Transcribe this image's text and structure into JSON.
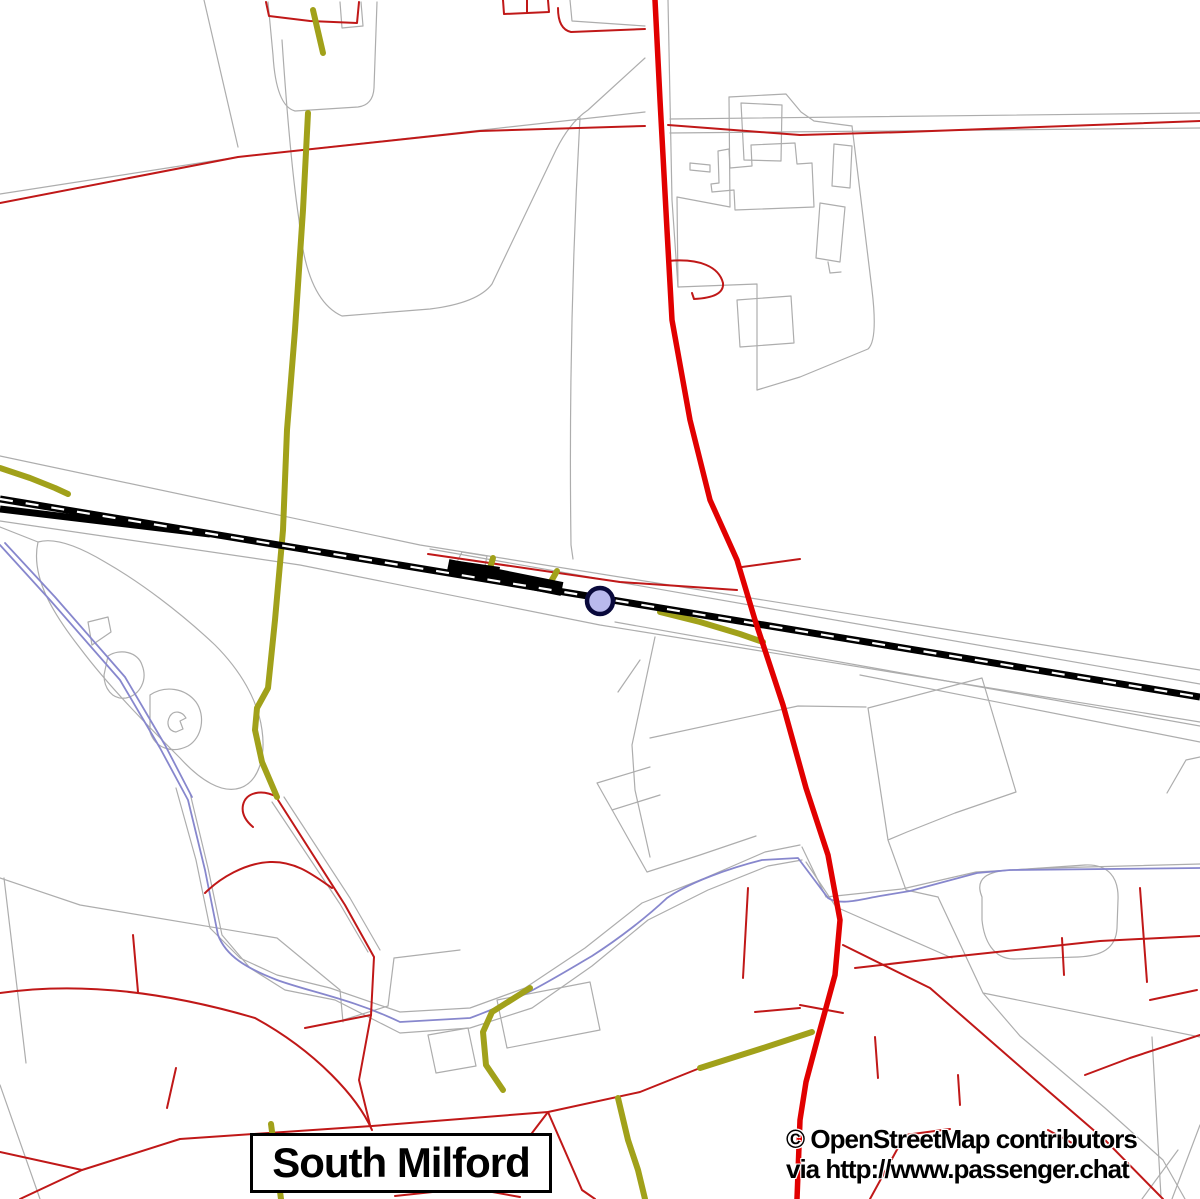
{
  "labels": {
    "place": "South Milford",
    "attribution_line1": "© OpenStreetMap contributors",
    "attribution_line2": "via http://www.passenger.chat"
  },
  "map": {
    "width": 1200,
    "height": 1199,
    "background": "#ffffff",
    "colors": {
      "boundary_gray": "#adadad",
      "stream_blue": "#8787cd",
      "road_thin_red": "#c01818",
      "track_olive": "#a1a11a",
      "railway_black": "#000000",
      "railway_dash_white": "#ffffff",
      "road_primary_red": "#e10000",
      "station_fill": "#b9b9ec",
      "station_ring": "#0a0a3c"
    },
    "station": {
      "cx": 600,
      "cy": 601,
      "r": 13,
      "fill": "#b9b9ec",
      "stroke": "#0a0a3c",
      "stroke_width": 4.5
    },
    "layers": [
      {
        "name": "boundaries-gray",
        "stroke": "#adadad",
        "width": 1.2,
        "cap": "round",
        "paths": [
          "M204,0 L238,147",
          "M0,194 L238,157 L645,112",
          "M670,119 L1200,113",
          "M670,133 L1200,128",
          "M268,2 L273,55 Q276,106 295,111 L358,107 Q373,105 374,88 L377,2",
          "M340,2 L342,28 L363,26 L361,2",
          "M282,40 Q290,160 299,220 Q306,300 342,316 L430,309 Q478,303 492,284 L556,150 Q570,122 588,110 L645,58",
          "M580,118 C572,260 569,400 571,545 L573,559",
          "M570,0 L572,21 L645,26",
          "M668,0 L672,200 L678,287",
          "M729,97 L786,94 L801,112 L814,121 L852,126",
          "M729,97 L730,207 L677,197 L678,287",
          "M852,126 L872,290 Q878,340 868,349 L800,377 L757,390",
          "M678,287 L757,284 L757,390",
          "M737,300 L791,296 L794,343 L740,347 Z",
          "M741,103 L782,105 L781,161 L744,160 Z",
          "M718,151 L729,149 L730,168 L752,166 L751,145 L795,143 L797,164 L812,163 L814,207 L735,210 L734,190 L712,192 L711,184 L719,183 Z",
          "M690,163 L710,165 L710,172 L690,170 Z",
          "M834,144 L852,146 L850,188 L832,186 Z",
          "M820,203 L845,207 L840,262 L816,258 Z M828,262 L830,273 L841,272",
          "M0,456 L420,545 L1200,670",
          "M430,549 L1200,684",
          "M0,521 L300,565 L600,625 L1200,722",
          "M615,622 L1200,726",
          "M860,675 L1200,742",
          "M458,560 L462,552 L487,556 L485,566",
          "M868,708 L982,678 L1016,792 L955,813 L907,832 L888,840 Z M888,840 L906,890 L938,897",
          "M650,738 L798,706 L866,707",
          "M655,637 L632,745 L635,790 L650,857",
          "M640,660 L618,692",
          "M597,783 L650,767 M612,810 L660,795 M597,783 L647,872 L700,855 L756,836",
          "M1167,793 L1186,760 L1200,757",
          "M982,897 C974,878 988,871 1012,870 L1085,865 C1108,864 1119,877 1118,900 L1117,928 C1116,949 1101,956 1078,957 L1014,959 C993,959 984,940 982,920 Z",
          "M802,847 L826,897 L902,889 L976,872 L1048,868 L1200,864",
          "M806,862 L836,907 L952,958",
          "M938,897 L983,993 L1020,1036 L1105,1108 L1163,1160 L1185,1199 M983,993 L1200,1037 M1152,1037 L1161,1197",
          "M176,788 L196,860 L210,928 L240,958 L277,975 L330,988 L400,1012 L470,1008 L525,988 L585,948 L642,903 L705,878 L765,852 L800,845",
          "M190,793 L208,868 L222,935 L250,968 L285,990 L335,1000 L400,1033 L470,1028 L532,1008 L592,966 L648,920 L708,890 L768,866 L802,860",
          "M0,878 L80,905 L277,938 L340,990 L343,1022 M4,878 L26,1063 M0,1085 L40,1199",
          "M272,802 L340,904 L368,952 M284,797 L350,898 L380,950",
          "M428,1035 L468,1028 L476,1066 L436,1073 Z M497,1000 L590,982 L600,1030 L507,1048 Z",
          "M343,1020 L388,1006 M388,1006 L394,958 L460,950",
          "M1178,1150 L1142,1199 M1200,1125 L1172,1199",
          "M38,542 C55,537 80,547 105,562 C140,582 180,612 215,645 C240,670 258,700 262,730 C266,758 258,782 240,788 C222,794 200,780 180,758 C150,728 110,688 80,648 C55,616 30,578 38,542 Z",
          "M88,622 L108,617 L111,632 L92,645 Z",
          "M108,656 C120,648 138,652 142,665 C148,680 140,695 126,698 C112,700 104,688 104,675 Z",
          "M150,695 C165,685 185,688 196,702 C206,716 202,738 188,746 C172,754 155,748 150,732 Z",
          "M170,716 C166,723 168,731 176,732 L183,729 L180,721 L186,718 C182,711 174,710 170,716 Z",
          "M0,527 L38,542"
        ]
      },
      {
        "name": "streams-blue",
        "stroke": "#8787cd",
        "width": 1.8,
        "cap": "round",
        "paths": [
          "M0,545 L50,600 L120,680 L160,748 L188,800 L205,870 L218,935 C226,956 246,968 277,980 C310,992 352,999 400,1022 L470,1018 C520,1000 556,977 592,956 C620,938 648,916 667,898 C690,882 730,868 762,860 L798,858 L828,898 C840,906 862,899 880,896 L910,891 L977,873 L1010,870 L1200,868",
          "M5,543 L55,597 L125,677 L165,745 L192,797"
        ]
      },
      {
        "name": "roads-red-thin",
        "stroke": "#c01818",
        "width": 2,
        "cap": "round",
        "paths": [
          "M0,203 L238,157 L480,131 L645,126",
          "M668,125 L800,135 L905,132 L1200,121",
          "M266,2 L269,16 L310,21 L357,23 L359,2",
          "M558,8 C558,22 562,30 571,32 L645,29",
          "M503,0 L504,14 L549,12 L548,0 M527,0 L527,13",
          "M668,261 C700,258 719,267 723,283 C724,293 714,298 694,299 L692,293",
          "M428,554 L620,582 L737,590",
          "M742,567 L800,559",
          "M0,993 C90,980 180,996 255,1018 C317,1052 358,1098 372,1130",
          "M180,1139 L372,1126 L548,1112 L640,1092 L700,1068",
          "M0,1152 L82,1170 L180,1139",
          "M20,1199 L82,1170",
          "M133,935 L138,992",
          "M167,1108 L176,1068",
          "M205,893 C220,878 245,863 270,862 C295,861 312,874 332,888",
          "M277,797 C262,789 246,792 243,805 C241,815 247,822 253,827",
          "M278,800 L345,905 L374,957 L371,1015 L359,1080 L370,1125",
          "M371,1015 L305,1028",
          "M548,1112 L582,1190 L595,1199",
          "M450,1190 L513,1158 L548,1112",
          "M395,1196 L470,1188 L520,1197",
          "M748,888 L743,978",
          "M755,1012 L800,1008",
          "M843,945 L930,988 L1032,1077 L1105,1140 L1163,1199",
          "M855,968 L950,957 L1100,941 L1200,936",
          "M800,1005 L843,1013",
          "M875,1037 L878,1078 M958,1075 L960,1105 M1062,938 L1064,975 M1140,888 L1147,982",
          "M870,1199 L905,1135 L950,1129",
          "M1200,1035 L1130,1058 L1085,1075",
          "M1150,1000 L1197,990",
          "M1048,1130 L1072,1143"
        ]
      },
      {
        "name": "tracks-olive",
        "stroke": "#a1a11a",
        "width": 6,
        "cap": "round",
        "paths": [
          "M313,10 L323,53",
          "M308,113 L303,210 L295,330 L287,430 L283,530 L275,620 L268,688 L257,708 L255,730 L262,762 L277,797",
          "M0,468 L30,478 L55,488 L68,494",
          "M660,612 L700,622 L740,634 L763,642",
          "M530,988 L492,1012 L483,1032 L486,1065 L503,1090",
          "M618,1098 L628,1140 L638,1170 L645,1199",
          "M700,1068 L760,1049 L812,1032",
          "M488,575 L493,558",
          "M549,585 L557,571",
          "M271,1124 L281,1199"
        ]
      },
      {
        "name": "railway-track",
        "stroke": "#000000",
        "width": 7,
        "cap": "butt",
        "paths": [
          "M0,499 L1200,697",
          "M0,509 L210,534"
        ]
      },
      {
        "name": "railway-station-band",
        "stroke": "#000000",
        "width": 14,
        "cap": "butt",
        "paths": [
          "M448,566 L562,589"
        ]
      },
      {
        "name": "railway-sidings-black",
        "stroke": "none",
        "width": 0,
        "fill": "#000000",
        "cap": "butt",
        "paths": [
          "M452,560 L500,567 L498,578 L450,571 Z"
        ]
      },
      {
        "name": "railway-dashes",
        "stroke": "#ffffff",
        "width": 2.2,
        "cap": "butt",
        "dash": "13 13",
        "paths": [
          "M0,499 L1200,697"
        ]
      },
      {
        "name": "road-primary-red",
        "stroke": "#e10000",
        "width": 5.5,
        "cap": "round",
        "paths": [
          "M655,0 L660,100 L667,230 L672,320 L690,420 L710,500 L737,560 L755,620 L783,705 L806,788 L828,855 L840,920 L835,975 L818,1037 L806,1082 L800,1120 L797,1199"
        ]
      }
    ]
  }
}
